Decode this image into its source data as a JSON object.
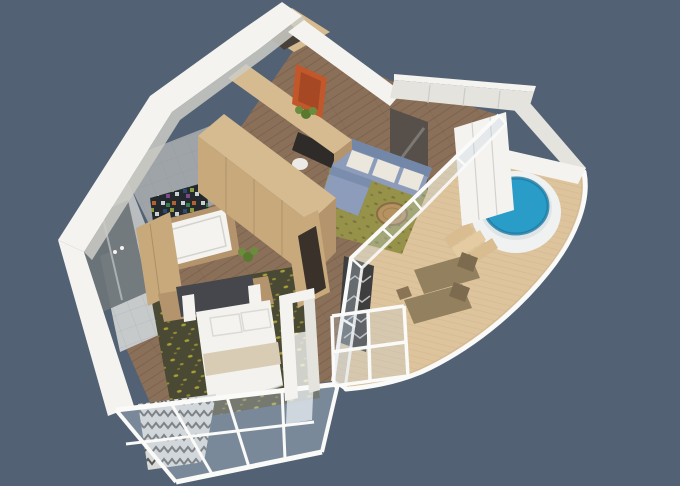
{
  "scene": {
    "type": "3d-floorplan-render",
    "description": "Isometric 3D cutaway floor plan of a one-bedroom suite with entry hall, bathroom, living room, bedroom, curved private terrace with round hot tub and two sun loungers",
    "rooms": [
      {
        "name": "entry-hall"
      },
      {
        "name": "bathroom"
      },
      {
        "name": "living-room"
      },
      {
        "name": "bedroom"
      },
      {
        "name": "hot-tub-terrace"
      },
      {
        "name": "sun-deck"
      }
    ]
  },
  "colors": {
    "background": "#526274",
    "white": "#f4f3f0",
    "white_shade": "#e4e3de",
    "white_dark": "#ccccc6",
    "wood_floor": "#8b7059",
    "wood_plank_line": "#5f4a3a",
    "deck": "#ddc49d",
    "deck_plank_line": "#c3a97f",
    "deck_shade": "#cfb38a",
    "oak_top": "#d6bb90",
    "oak_front": "#c7a97c",
    "oak_side": "#b4946c",
    "oak_dark": "#9c7f5c",
    "gray_wall": "#9ea4a7",
    "gray_wall_light": "#b9bdbf",
    "gray_floor": "#c7cacb",
    "tile_line": "#8d9296",
    "shower_glass": "#6d7478",
    "mosaic_base": "#23292d",
    "rug_bedroom": "#4a4933",
    "rug_speckle": "#b3aa36",
    "rug_living": "#96924a",
    "rug_living_dot": "#6f6c38",
    "sofa": "#8c9cba",
    "sofa_dark": "#7388a8",
    "cushion": "#ebe7dc",
    "table_wood": "#b5925f",
    "table_rim": "#8a6c45",
    "tub_white": "#f0f2f2",
    "tub_rim": "#dfe5e6",
    "tub_water": "#2a9cc8",
    "tub_water_dark": "#1e7ca4",
    "steps_wood": "#d9bc90",
    "steps_wood_light": "#e4cba1",
    "lounger": "#93805f",
    "lounger_dark": "#7c6b4f",
    "bed_white": "#f3f2ee",
    "bed_band": "#d9ccb4",
    "pillow_line": "#dcdad4",
    "headboard": "#45474c",
    "artwork": "#c2572b",
    "artwork_dark": "#8e3c1e",
    "plant": "#6c8c3d",
    "plant_dark": "#587a2e",
    "mirror": "#57504a",
    "mirror_shine": "#cfd6da",
    "desk_dark": "#2f2b28",
    "chair_white": "#eceae6",
    "curtain_dark": "#3e3e3e",
    "curtain_light": "#d9d9d7",
    "glass_tint": "#c5d5e2",
    "rail_white": "#fafaf8"
  }
}
